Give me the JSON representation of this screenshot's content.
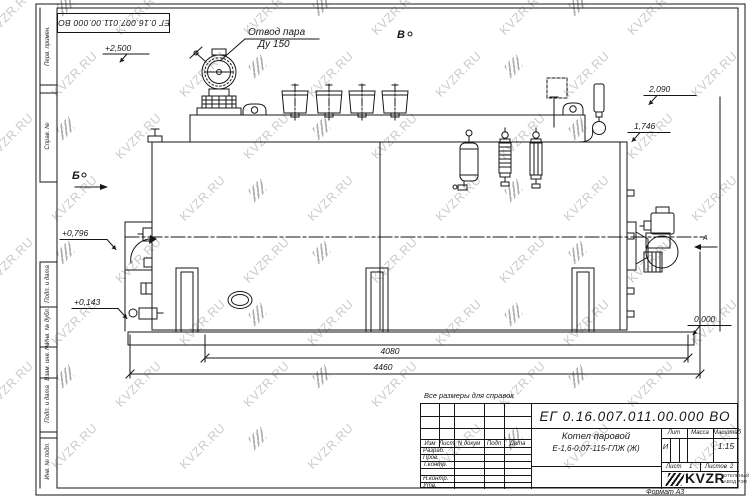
{
  "stamp_top": {
    "number": "ЕГ 0.16.007.011.00.000  ВО"
  },
  "frame": {
    "left_top_cells": [
      "Перв. примен.",
      "Справ. №"
    ],
    "left_bottom_cells": [
      "Подп. и дата",
      "Инв. № дубл.",
      "Взам. инв. №",
      "Подп. и дата",
      "Инв. № подл."
    ]
  },
  "note": "Все размеры для справок",
  "format": "Формат А3",
  "drawing": {
    "steam_outlet": {
      "line1": "Отвод пара",
      "line2": "Ду 150"
    },
    "views": {
      "b": "Б",
      "v": "В",
      "a": "А"
    },
    "elevations": {
      "e2500": "+2,500",
      "e2090": "2,090",
      "e1746": "1,746",
      "e0796": "+0,796",
      "e0143": "+0,143",
      "e0000": "0,000"
    },
    "dimensions": {
      "inner": "4080",
      "overall": "4460"
    }
  },
  "title_block": {
    "number": "ЕГ 0.16.007.011.00.000  ВО",
    "header_cols": [
      "Изм",
      "Лист",
      "N докум",
      "Подп",
      "Дата"
    ],
    "rows": [
      "Разраб.",
      "Пров.",
      "Т.контр.",
      "Н.контр.",
      "Утв."
    ],
    "product_name_line1": "Котел паровой",
    "product_name_line2": "Е-1,6-0,07-115-ГЛЖ (Ж)",
    "lit_label": "Лит",
    "lit_value": "И",
    "mass_label": "Масса",
    "scale_label": "Масштаб",
    "scale_value": "1:15",
    "sheet_label": "Лист",
    "sheet_value": "1",
    "sheets_label": "Листов",
    "sheets_value": "2",
    "logo_text": "KVZR",
    "logo_sub1": "КОТЕЛЬНЫЙ",
    "logo_sub2": "ЗАВОД РЭП"
  },
  "watermark": {
    "text": "KVZR.RU"
  }
}
